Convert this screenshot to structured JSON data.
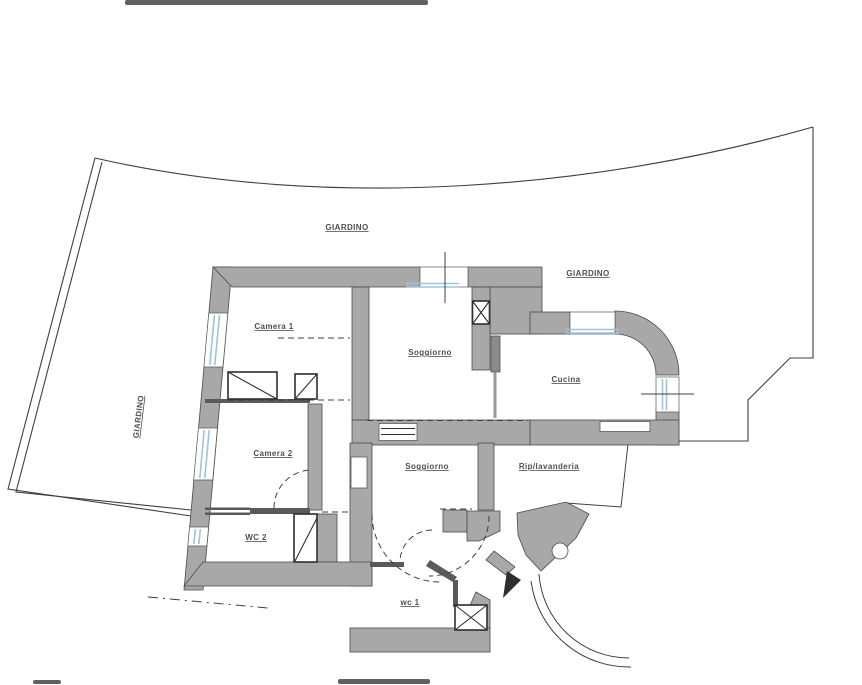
{
  "colors": {
    "wall": "#a8a8a8",
    "wallline": "#4a4a4a",
    "window": "#9fc4da",
    "ink": "#3f3f3f",
    "label": "#4f4f4f"
  },
  "site": {
    "garden_top": "GIARDINO",
    "garden_right": "GIARDINO",
    "garden_left": "GIARDINO"
  },
  "rooms": {
    "camera1": "Camera 1",
    "soggiorno_upper": "Soggiorno",
    "cucina": "Cucina",
    "camera2": "Camera 2",
    "soggiorno_lower": "Soggiorno",
    "rip_lavanderia": "Rip/lavanderia",
    "wc2": "WC 2",
    "wc1": "wc 1"
  }
}
